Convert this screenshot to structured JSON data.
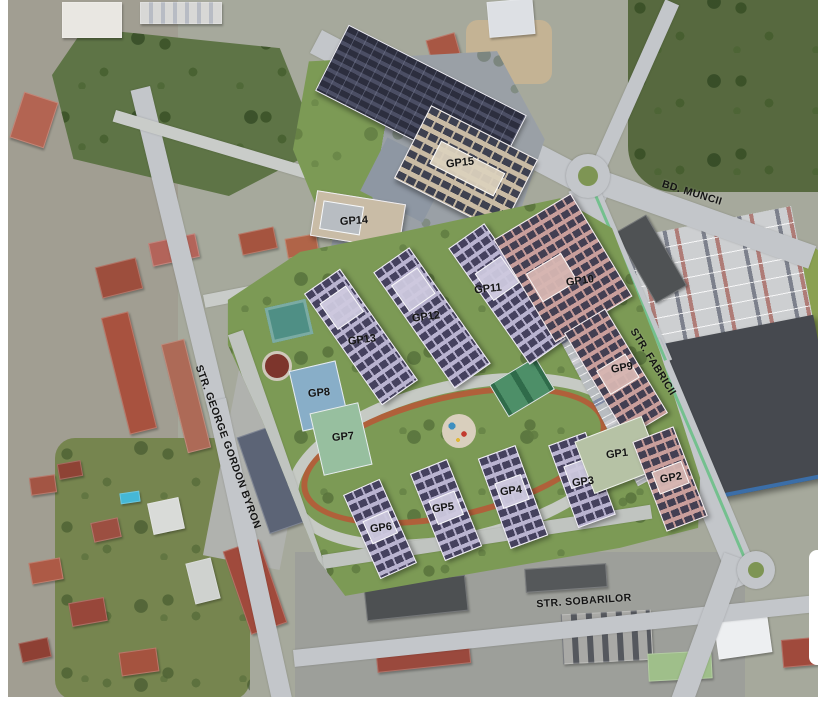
{
  "map": {
    "type": "aerial-site-plan",
    "streets": [
      {
        "id": "bd-muncii",
        "name": "BD. MUNCII"
      },
      {
        "id": "str-fabricii",
        "name": "STR. FABRICII"
      },
      {
        "id": "str-george-gordon-byron",
        "name": "STR. GEORGE GORDON BYRON"
      },
      {
        "id": "str-sobarilor",
        "name": "STR. SOBARILOR"
      }
    ],
    "buildings": [
      {
        "label": "GP1"
      },
      {
        "label": "GP2"
      },
      {
        "label": "GP3"
      },
      {
        "label": "GP4"
      },
      {
        "label": "GP5"
      },
      {
        "label": "GP6"
      },
      {
        "label": "GP7"
      },
      {
        "label": "GP8"
      },
      {
        "label": "GP9"
      },
      {
        "label": "GP10"
      },
      {
        "label": "GP11"
      },
      {
        "label": "GP12"
      },
      {
        "label": "GP13"
      },
      {
        "label": "GP14"
      },
      {
        "label": "GP15"
      }
    ],
    "colors": {
      "apartment_roof": "#b9b3d0",
      "solar_panel": "#45415e",
      "commercial_roof": "#c99e9b",
      "office_roof": "#c9bba4",
      "green_space": "#7c9a55",
      "court_blue": "#88aec8",
      "court_green": "#97bf9f",
      "running_track": "#b0603a",
      "road": "#c3c6ca"
    }
  }
}
